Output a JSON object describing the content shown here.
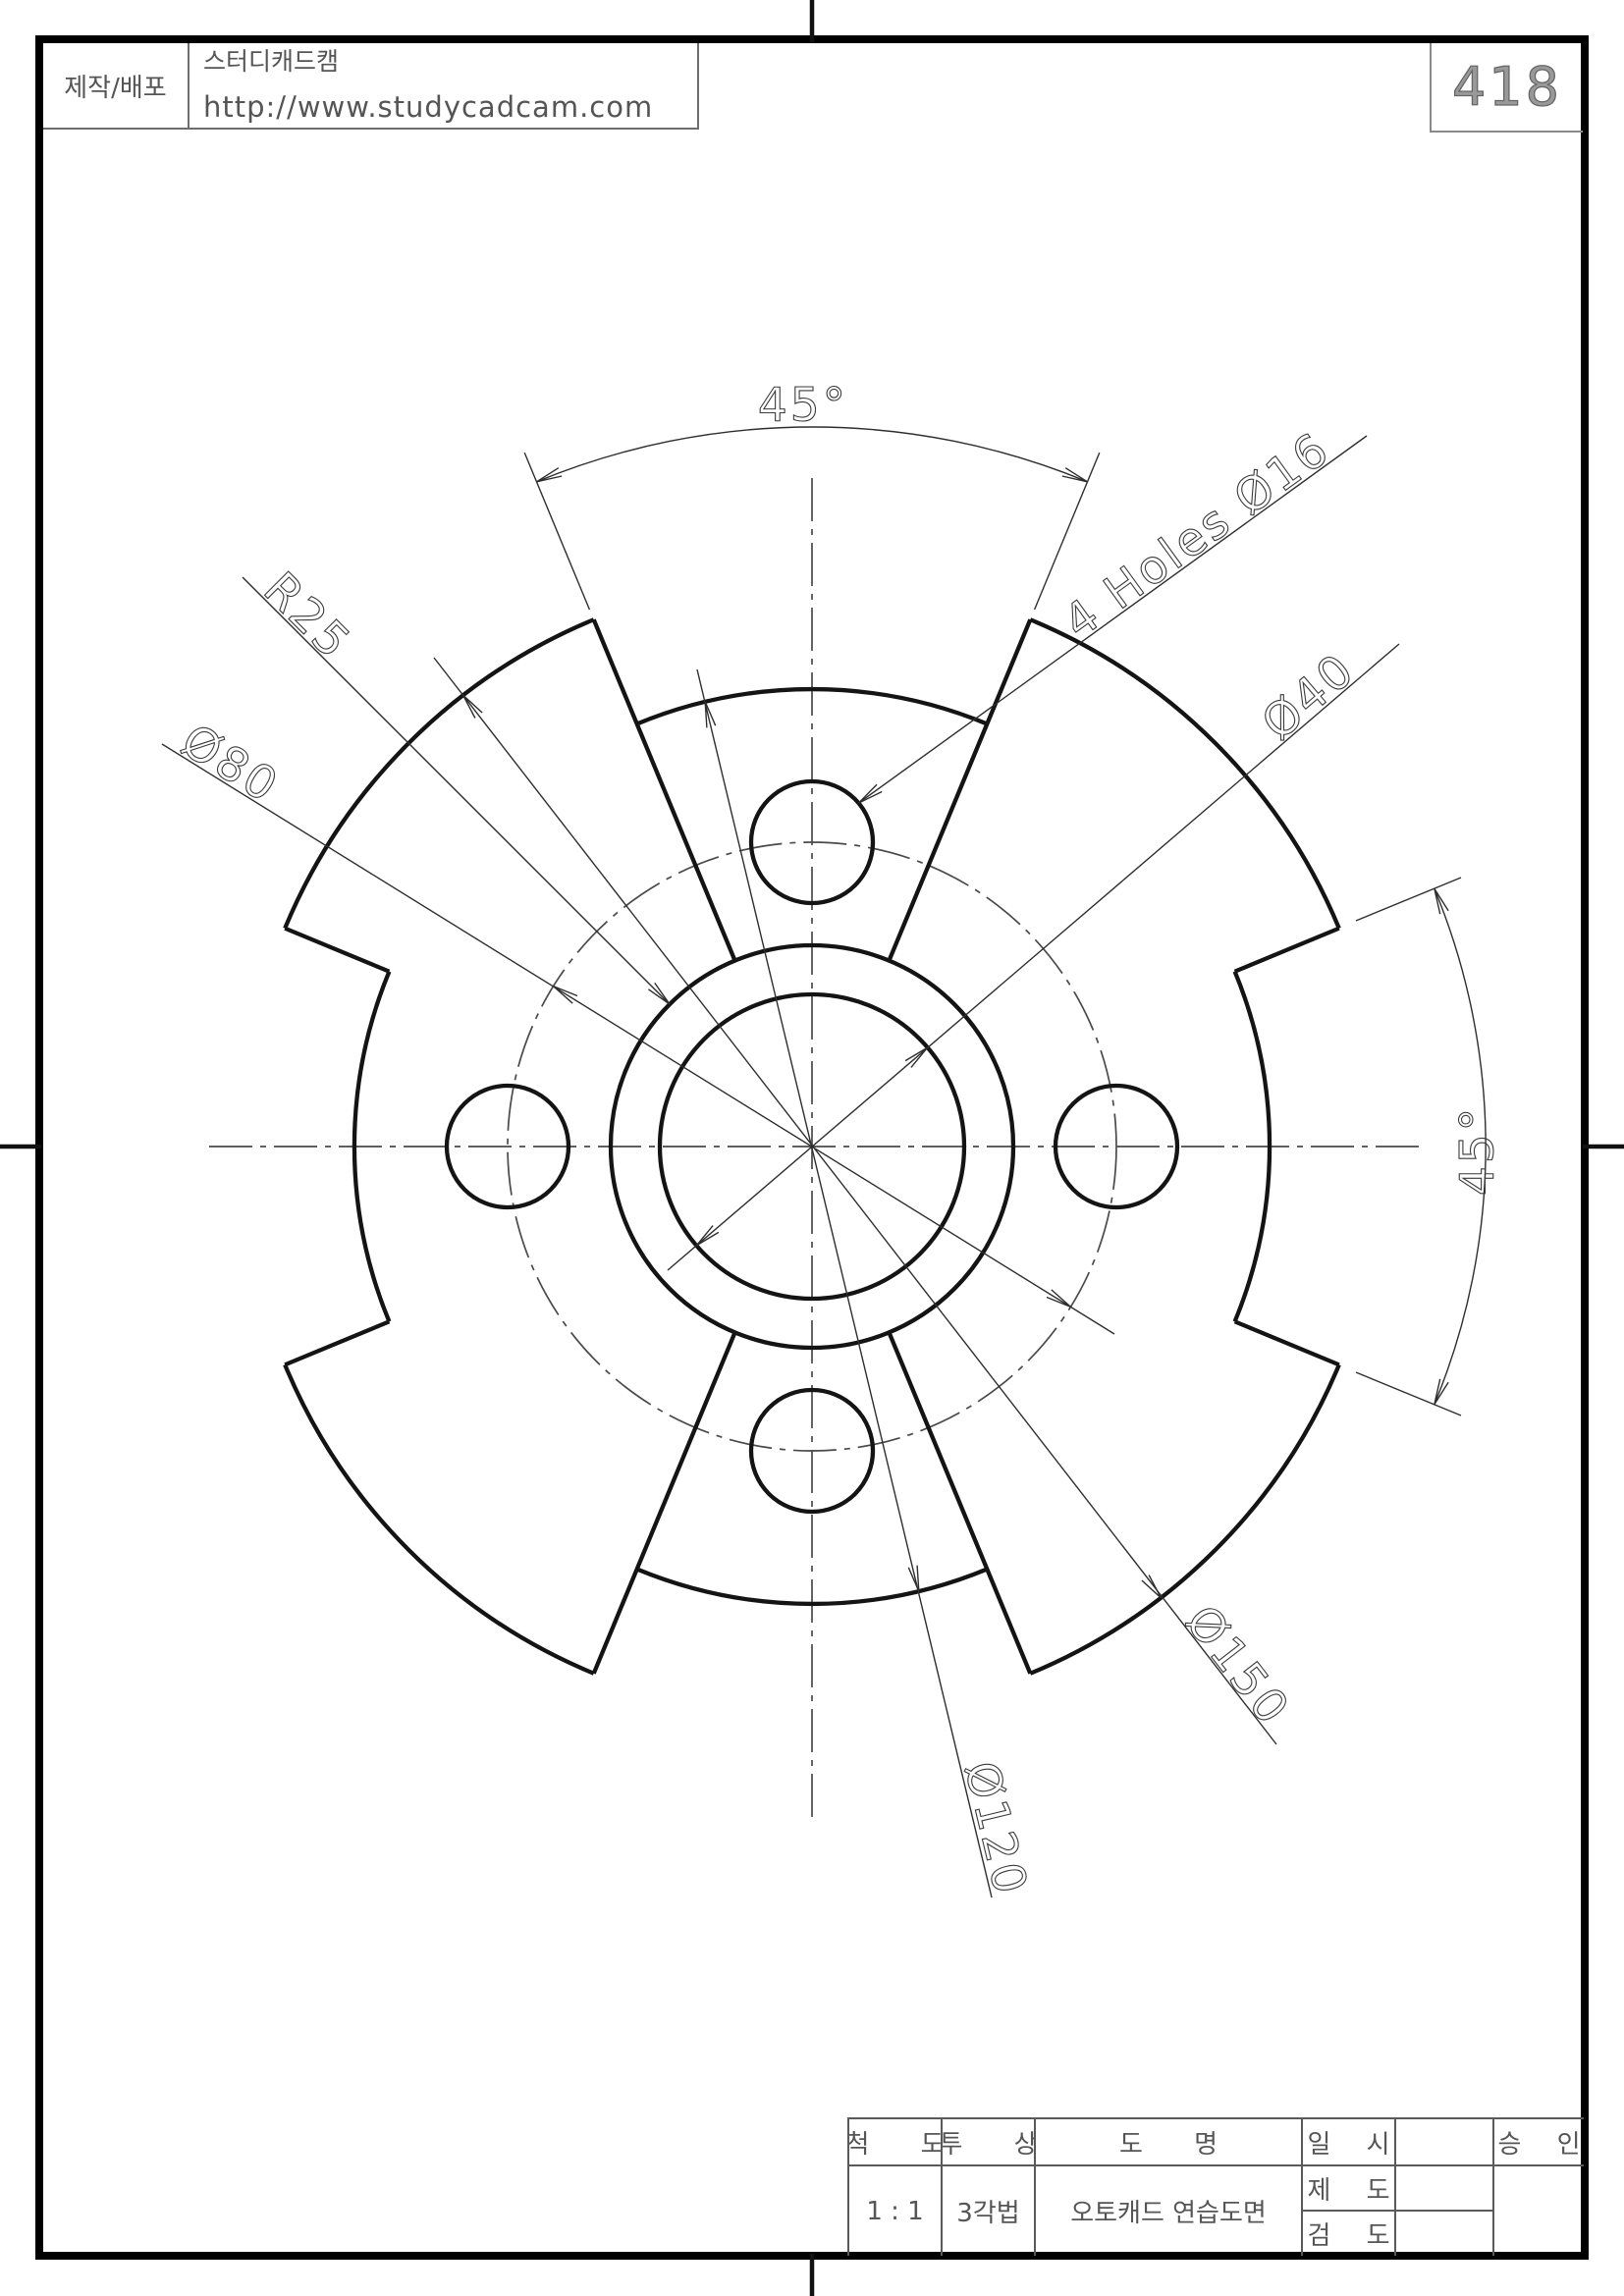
{
  "page": {
    "number": "418"
  },
  "publisher": {
    "role_label": "제작/배포",
    "brand": "스터디캐드캠",
    "url": "http://www.studycadcam.com"
  },
  "dimensions": {
    "top_angle": "45°",
    "side_angle": "45°",
    "hub_radius": "R25",
    "bolt_circle_dia": "Ø80",
    "center_hole_dia": "Ø40",
    "holes_note": "4 Holes Ø16",
    "outer_dia": "Ø150",
    "slot_step_dia": "Ø120"
  },
  "title_block": {
    "scale_label": "척 도",
    "scale_value": "1 : 1",
    "projection_label": "투 상",
    "projection_value": "3각법",
    "drawing_name_label": "도 명",
    "drawing_name_value": "오토캐드 연습도면",
    "date_label": "일 시",
    "draft_label": "제 도",
    "check_label": "검 도",
    "approval_label": "승 인"
  }
}
